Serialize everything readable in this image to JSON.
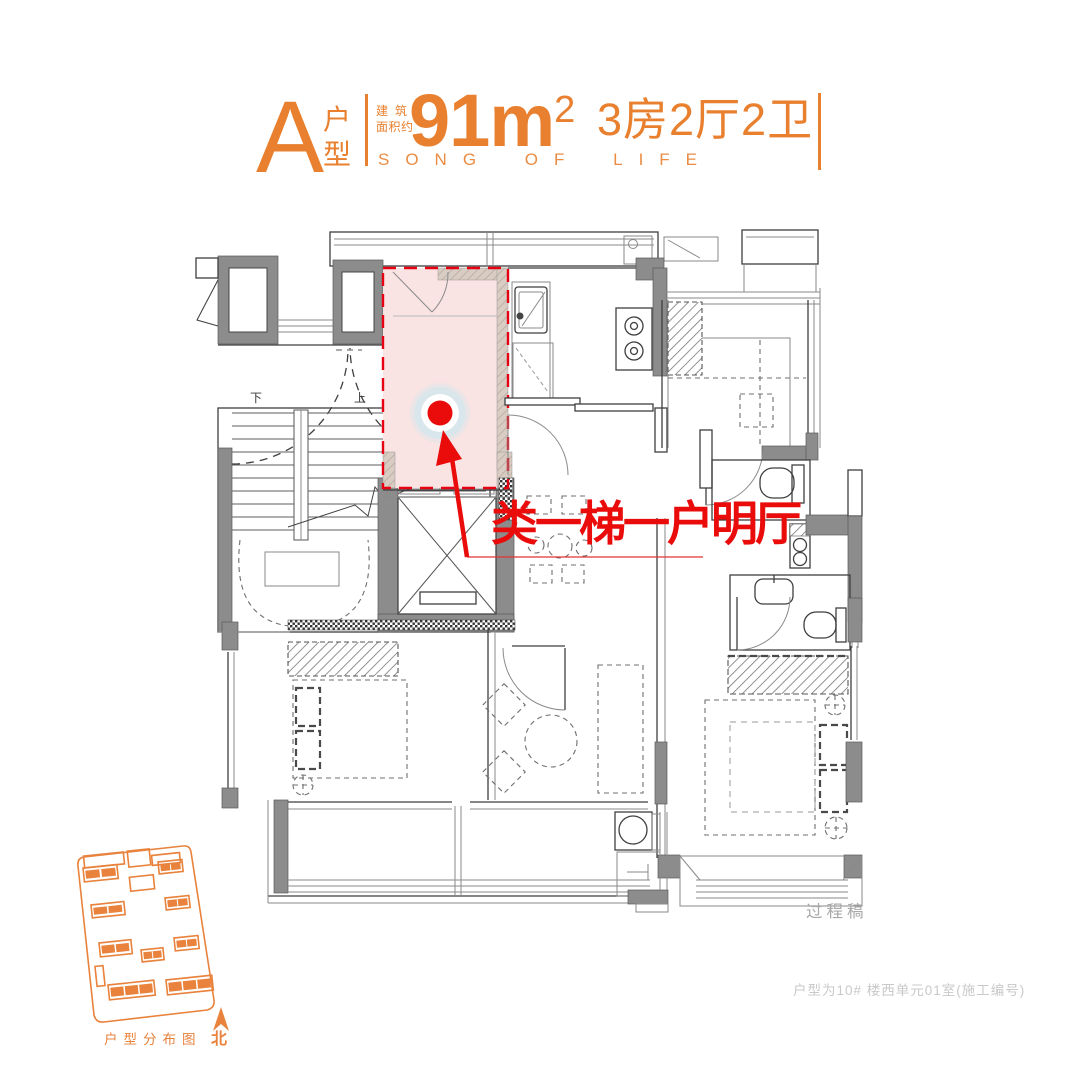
{
  "header": {
    "type_letter": "A",
    "type_chars": [
      "户",
      "型"
    ],
    "area_label_line1": "建筑",
    "area_label_line2": "面积约",
    "area_number": "91",
    "area_unit": "m",
    "area_exponent": "2",
    "rooms_text": "3房2厅2卫",
    "slogan": "SONG OF LIFE"
  },
  "plan": {
    "stairs_down_label": "下",
    "stairs_up_label": "上"
  },
  "annotation": {
    "highlight_text": "类一梯一户明厅"
  },
  "site_map": {
    "caption": "户型分布图",
    "north_label": "北"
  },
  "footer": {
    "draft_label": "过程稿",
    "unit_note": "户型为10# 楼西单元01室(施工编号)"
  },
  "colors": {
    "accent": "#E8802F",
    "highlight_red": "#EA0B0B",
    "dash_red": "#E60012",
    "pink": "#FAE3E3",
    "wall_gray": "#8C8C8C",
    "site_orange": "#E8823C"
  }
}
